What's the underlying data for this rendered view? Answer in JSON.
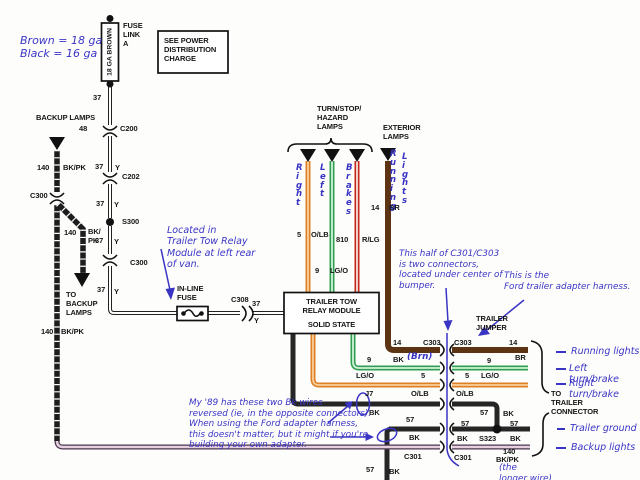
{
  "colors": {
    "note_blue": "#3a34c4",
    "wire_black": "#262626",
    "wire_brown": "#5d3413",
    "wire_orange": "#dd8026",
    "wire_orange_core": "#f8cf9a",
    "wire_green": "#2f9e50",
    "wire_green_core": "#d2f2da",
    "wire_red": "#c5271d",
    "wire_red_core": "#f3e4da",
    "wire_purple": "#4c3850",
    "wire_purple_core": "#e6d0e0"
  },
  "labels": {
    "gauge_note": "Brown = 18 ga\nBlack = 16 ga",
    "fuse_link_a": "FUSE\nLINK\nA",
    "ga_brown": "18 GA BROWN",
    "power_box": "SEE POWER\nDISTRIBUTION\nCHARGE",
    "n37_top": "37",
    "n48": "48",
    "c200": "C200",
    "n37_b": "37",
    "y_b": "Y",
    "c202": "C202",
    "n37_c": "37",
    "y_c": "Y",
    "s300": "S300",
    "n37_d": "37",
    "y_d": "Y",
    "c300_right": "C300",
    "n37_e": "37",
    "y_e": "Y",
    "backup_lamps": "BACKUP LAMPS",
    "n140_a": "140",
    "bkpk_a": "BK/PK",
    "c300_left": "C300",
    "n140_b": "140",
    "bkpk_b": "BK/\nPK",
    "to_backup": "TO\nBACKUP\nLAMPS",
    "n140_c": "140",
    "bkpk_c": "BK/PK",
    "inline_fuse": "IN-LINE\nFUSE",
    "c308": "C308",
    "n37_f": "37",
    "y_f": "Y",
    "located_note": "Located in\nTrailer Tow Relay\nModule at left rear\nof van.",
    "turn_stop": "TURN/STOP/\nHAZARD\nLAMPS",
    "exterior": "EXTERIOR\nLAMPS",
    "v_right": "Right",
    "v_left": "Left",
    "v_brakes": "Brakes",
    "v_running": "Running",
    "v_lights": "Lights",
    "n5_a": "5",
    "olb_a": "O/LB",
    "n810": "810",
    "rlg": "R/LG",
    "n9_a": "9",
    "lgo_a": "LG/O",
    "n14_a": "14",
    "br_a": "BR",
    "relay_title": "TRAILER TOW\nRELAY MODULE",
    "relay_sub": "SOLID STATE",
    "connector_note": "This half of C301/C303\nis two connectors,\nlocated under center of\nbumper.",
    "harness_note": "This is the\nFord trailer adapter harness.",
    "trailer_jumper": "TRAILER\nJUMPER",
    "n14_b": "14",
    "c303_l": "C303",
    "c303_r": "C303",
    "n14_c": "14",
    "n9_b": "9",
    "bk_label": "BK",
    "brn_note": "(Brn)",
    "lgo_b": "LG/O",
    "n5_b": "5",
    "j7": "J7",
    "olb_b": "O/LB",
    "bk_a": "BK",
    "br_b": "BR",
    "n9_c": "9",
    "n5_c": "5",
    "lgo_c": "LG/O",
    "olb_c": "O/LB",
    "n57_a": "57",
    "bk_b": "BK",
    "n57_b": "57",
    "bk_c": "BK",
    "n57_c": "57",
    "bk_d": "BK",
    "s323": "S323",
    "n57_d": "57",
    "bk_e": "BK",
    "n57_e": "57",
    "bk_f": "BK",
    "c301_l": "C301",
    "c301_r": "C301",
    "n140_d": "140",
    "bkpk_d": "BK/PK",
    "longer_wire": "(the\nlonger wire)",
    "to_trailer_connector": "TO\nTRAILER\nCONNECTOR",
    "running_lights": "Running lights",
    "left_turn": "Left turn/brake",
    "right_turn": "Right turn/brake",
    "trailer_ground": "Trailer ground",
    "backup_lights": "Backup lights",
    "reversed_note": "My '89 has these two Bk wires\nreversed (ie, in the opposite connectors).\nWhen using the Ford adapter harness,\nthis doesn't matter, but it might if you're\nbuilding your own adapter."
  }
}
